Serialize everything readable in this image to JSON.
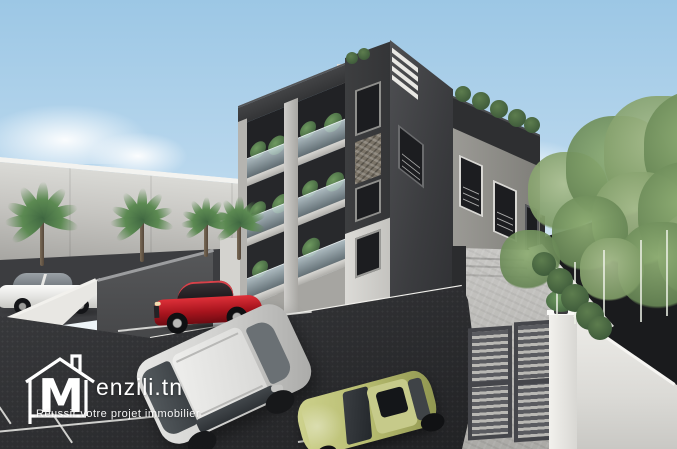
{
  "watermark": {
    "logo_letter": "M",
    "brand": "enzili.tn",
    "tagline": "Réussir votre projet immobilier"
  },
  "palette": {
    "sky_top": "#9cc7e5",
    "sky_horizon": "#eef4f7",
    "building_charcoal": "#3a3b3d",
    "building_concrete": "#c2c1bd",
    "building_white": "#e9e8e4",
    "asphalt": "#2b2c2f",
    "parking_line": "#e8e8e6",
    "foliage": "#84a06c",
    "palm_green": "#4a7344",
    "car_red": "#b01c26",
    "car_silver": "#d6d6d4",
    "car_lime": "#b9bd72",
    "gate_gray": "#4b4c50",
    "watermark_white": "#ffffff"
  }
}
